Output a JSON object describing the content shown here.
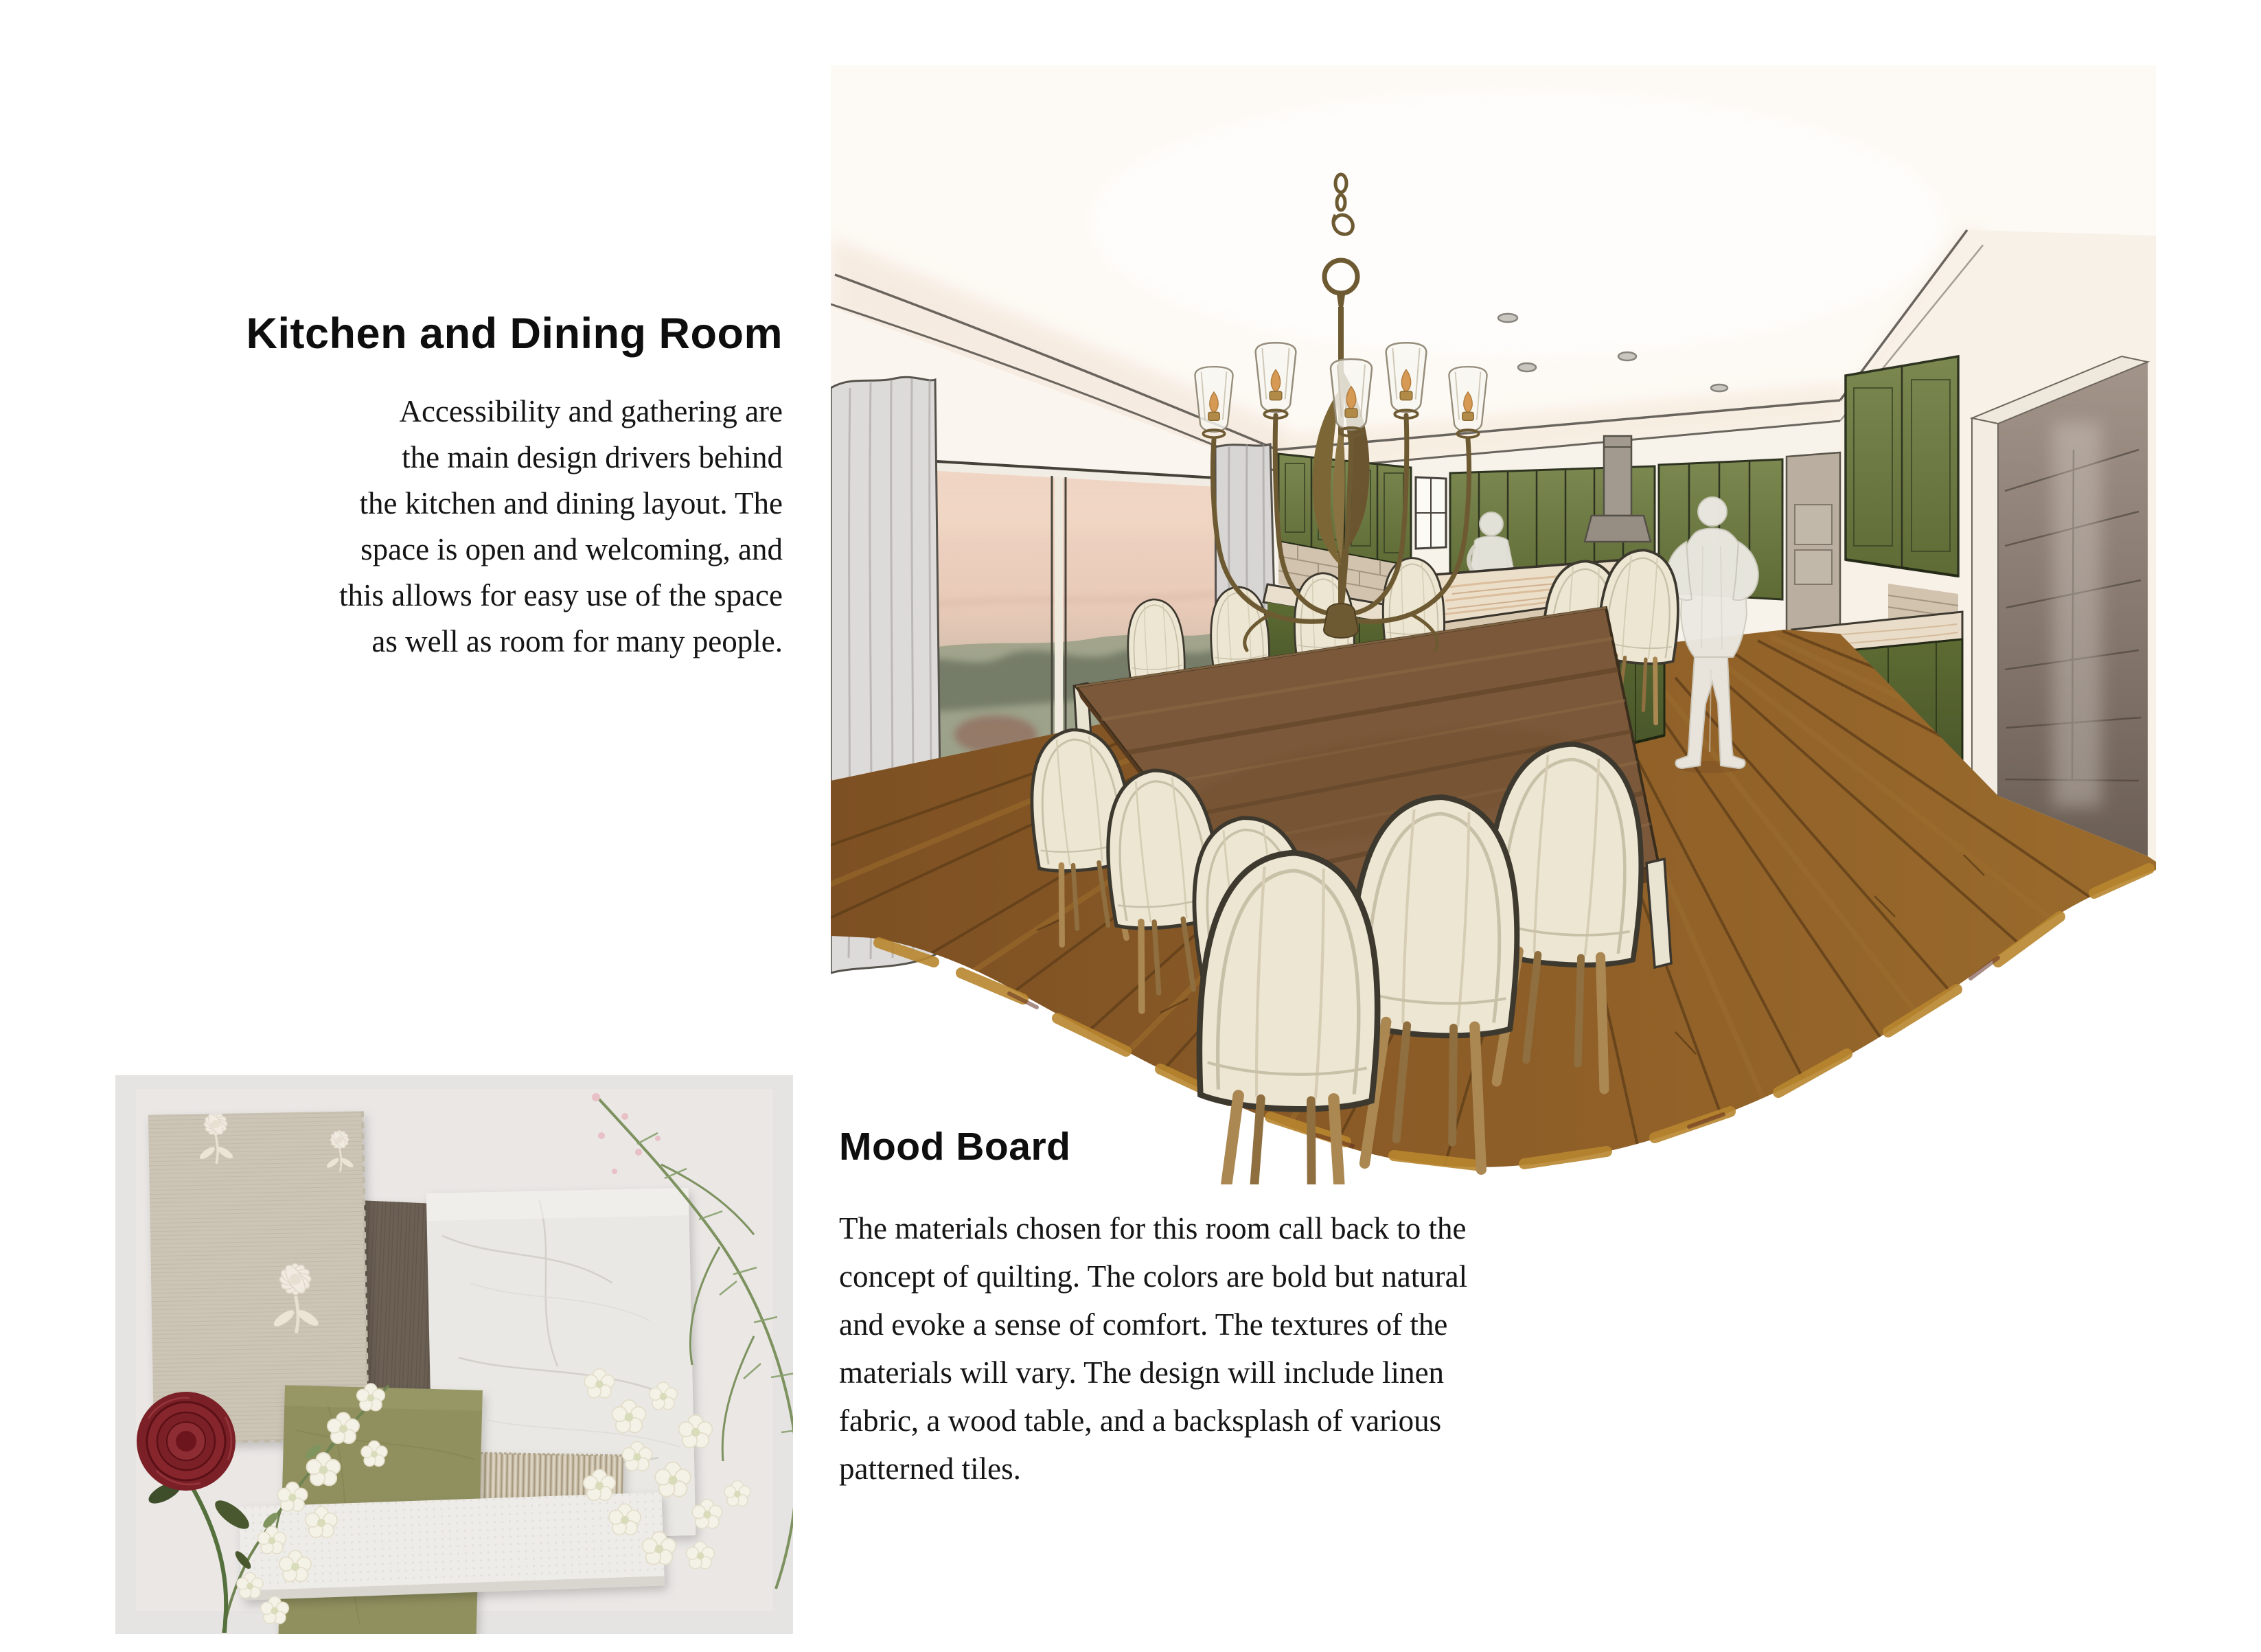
{
  "page": {
    "background": "#ffffff"
  },
  "kitchen_section": {
    "title": "Kitchen and Dining Room",
    "body_lines": [
      "Accessibility and gathering are",
      "the main design drivers behind",
      "the kitchen and dining layout. The",
      "space is open and welcoming, and",
      "this allows for easy use of the space",
      "as well as room for many people."
    ]
  },
  "mood_section": {
    "title": "Mood Board",
    "body_lines": [
      "The materials chosen for this room call back to the",
      "concept of quilting. The colors are bold but natural",
      "and evoke a sense of comfort. The textures of the",
      "materials will vary. The design will include linen",
      "fabric, a wood table, and a backsplash of various",
      "patterned tiles."
    ]
  },
  "illustration": {
    "name": "kitchen-dining-room-rendering",
    "palette": {
      "cabinet_green": "#6f7d42",
      "island_green": "#55652e",
      "table_wood": "#7b5839",
      "floor_brown": "#8a5c28",
      "floor_edge_mustard": "#b8862f",
      "wall_cream": "#f6efe7",
      "curtain_gray": "#dddbd9",
      "chair_cream": "#ece6d3",
      "bronze_fixture": "#6e5a32"
    }
  },
  "mood_board_photo": {
    "name": "mood-board-photo",
    "palette": {
      "background_gray": "#e9e7e6",
      "linen": "#ccc5b6",
      "dark_wood": "#6c6055",
      "marble": "#eae8e4",
      "olive_swatch": "#90905e",
      "woven_fabric": "#c7bca8",
      "white_tile": "#eeece8",
      "rose_red": "#7c2027",
      "greenery": "#7d925f"
    }
  }
}
